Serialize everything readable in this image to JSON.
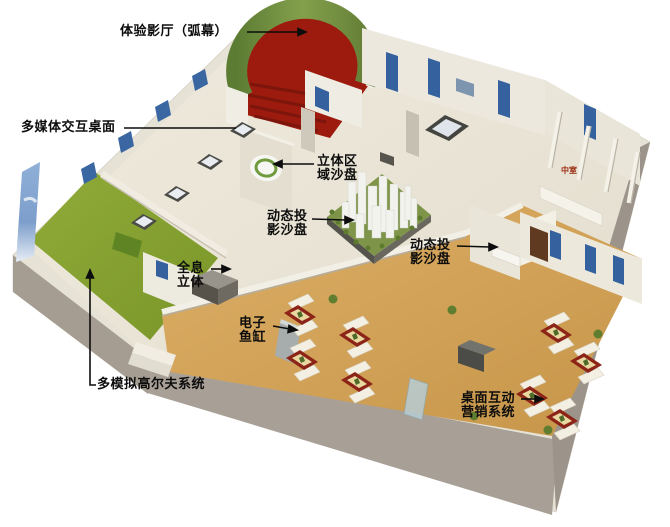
{
  "page": {
    "background": "#ffffff"
  },
  "colors": {
    "outer_wall_gray": "#a8a096",
    "wall_cream": "#e6e2d6",
    "floor_cream": "#ebe6d8",
    "wood_floor": "#d2a35b",
    "carpet_red": "#9c1b0e",
    "grass_green": "#87a133",
    "screen_image_green": "#6f8f3f",
    "niche_picture_blue": "#35619e",
    "water_wall_blue": "#7d9ecb",
    "table_frame_red": "#8c2418",
    "sofa_white": "#f3efe3",
    "label_black": "#0d0d0d",
    "sign_red": "#9b2b10"
  },
  "labels": {
    "theater": "体验影厅（弧幕）",
    "multimedia_table": "多媒体交互桌面",
    "stereo_zone_line1": "立体区",
    "stereo_zone_line2": "域沙盘",
    "dynamic_sand_left_line1": "动态投",
    "dynamic_sand_left_line2": "影沙盘",
    "dynamic_sand_right_line1": "动态投",
    "dynamic_sand_right_line2": "影沙盘",
    "hologram_line1": "全息",
    "hologram_line2": "立体",
    "fish_tank_line1": "电子",
    "fish_tank_line2": "鱼缸",
    "golf": "多模拟高尔夫系统",
    "desktop_marketing_line1": "桌面互动",
    "desktop_marketing_line2": "营销系统",
    "room_sign": "中室"
  }
}
